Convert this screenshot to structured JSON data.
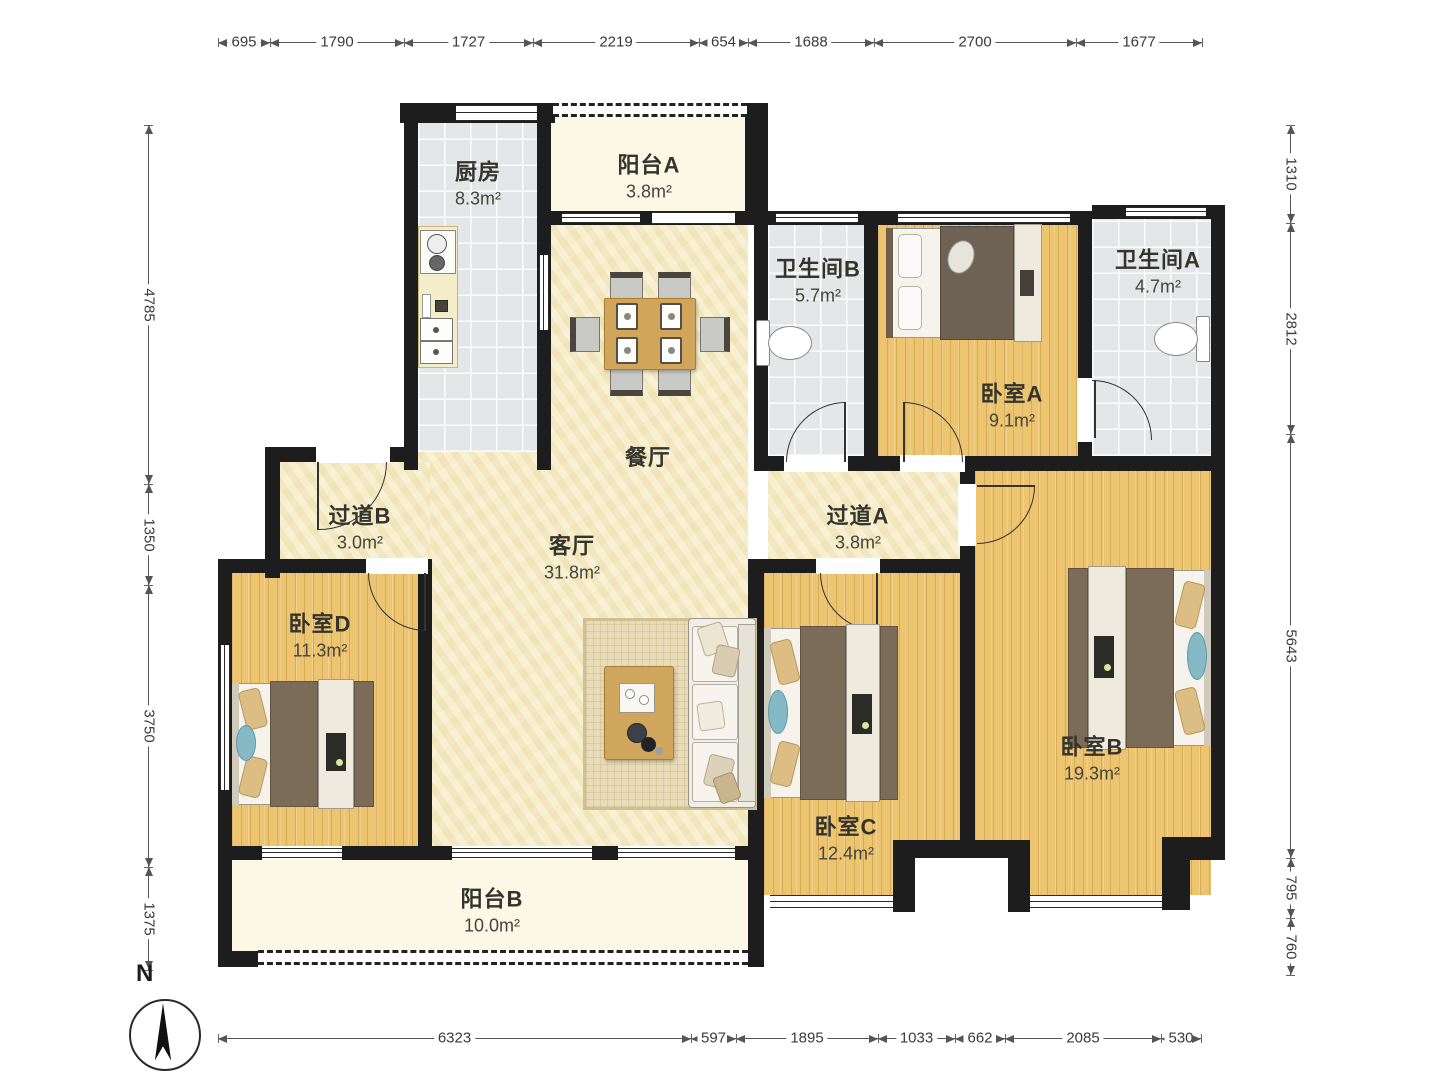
{
  "plan_title": "4室2厅户型图",
  "rooms": [
    {
      "id": "kitchen",
      "name": "厨房",
      "area": "8.3m²"
    },
    {
      "id": "balcony-a",
      "name": "阳台A",
      "area": "3.8m²"
    },
    {
      "id": "bath-b",
      "name": "卫生间B",
      "area": "5.7m²"
    },
    {
      "id": "bedroom-a",
      "name": "卧室A",
      "area": "9.1m²"
    },
    {
      "id": "bath-a",
      "name": "卫生间A",
      "area": "4.7m²"
    },
    {
      "id": "hall-b",
      "name": "过道B",
      "area": "3.0m²"
    },
    {
      "id": "dining",
      "name": "餐厅",
      "area": ""
    },
    {
      "id": "living",
      "name": "客厅",
      "area": "31.8m²"
    },
    {
      "id": "hall-a",
      "name": "过道A",
      "area": "3.8m²"
    },
    {
      "id": "bedroom-d",
      "name": "卧室D",
      "area": "11.3m²"
    },
    {
      "id": "bedroom-c",
      "name": "卧室C",
      "area": "12.4m²"
    },
    {
      "id": "bedroom-b",
      "name": "卧室B",
      "area": "19.3m²"
    },
    {
      "id": "balcony-b",
      "name": "阳台B",
      "area": "10.0m²"
    }
  ],
  "dimensions": {
    "top": [
      "695",
      "1790",
      "1727",
      "2219",
      "654",
      "1688",
      "2700",
      "1677"
    ],
    "bottom": [
      "6323",
      "597",
      "1895",
      "1033",
      "662",
      "2085",
      "530"
    ],
    "left": [
      "4785",
      "1350",
      "3750",
      "1375"
    ],
    "right": [
      "1310",
      "2812",
      "5643",
      "795",
      "760"
    ]
  },
  "compass": {
    "label": "N"
  },
  "colors": {
    "wall": "#1d1d1d",
    "wood_floor": "#edc571",
    "tile_floor": "#e4e6e8",
    "living_floor": "#f7efce",
    "balcony_floor": "#fbf9e6",
    "table_wood": "#d2a65a",
    "duvet_brown": "#7b6b59",
    "accent_blue": "#85b9c6"
  }
}
